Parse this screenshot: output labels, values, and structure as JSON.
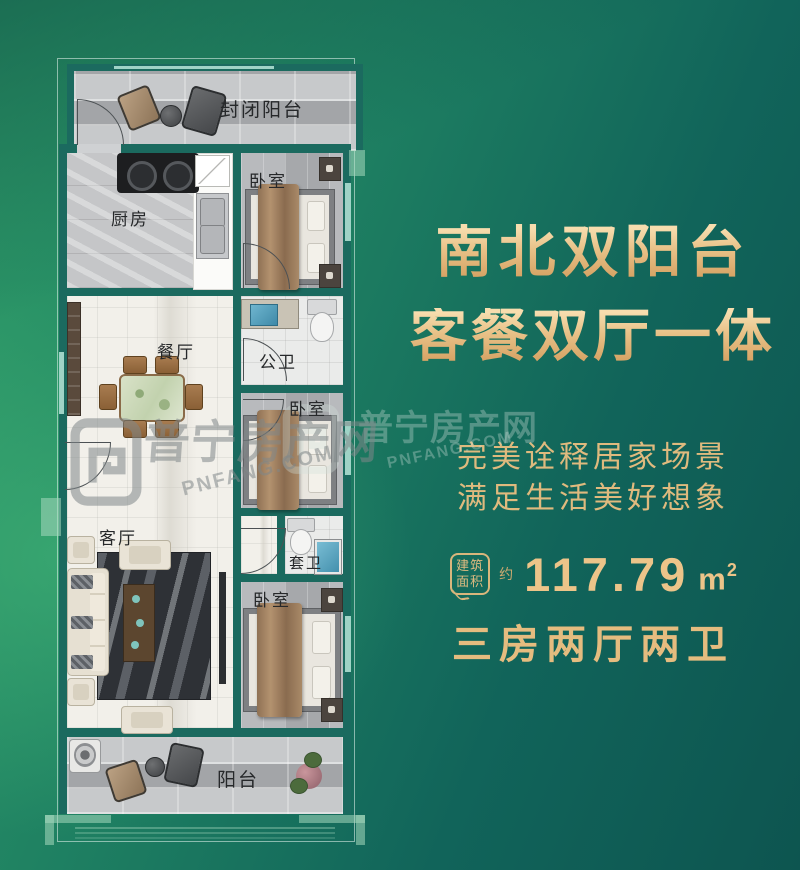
{
  "poster": {
    "headline_line1": "南北双阳台",
    "headline_line2": "客餐双厅一体",
    "subtitle_line1": "完美诠释居家场景",
    "subtitle_line2": "满足生活美好想象",
    "area_badge_top": "建筑",
    "area_badge_bottom": "面积",
    "area_approx": "约",
    "area_value": "117.79",
    "area_unit_base": "m",
    "area_unit_sup": "2",
    "spec": "三房两厅两卫"
  },
  "watermark": {
    "name": "普宁房产网",
    "domain": "PNFANG.COM"
  },
  "floorplan": {
    "rooms": {
      "enclosed_balcony": "封闭阳台",
      "kitchen": "厨房",
      "bedroom_top": "卧室",
      "dining": "餐厅",
      "bath_public": "公卫",
      "bedroom_mid": "卧室",
      "living": "客厅",
      "bath_ensuite": "套卫",
      "bedroom_bottom": "卧室",
      "balcony": "阳台"
    }
  },
  "colors": {
    "accent_gold": "#e6bd81",
    "wall_teal": "#1b6a5f",
    "background_green": "#2f9c68",
    "background_teal": "#0d5550",
    "room_label": "#26282a"
  }
}
